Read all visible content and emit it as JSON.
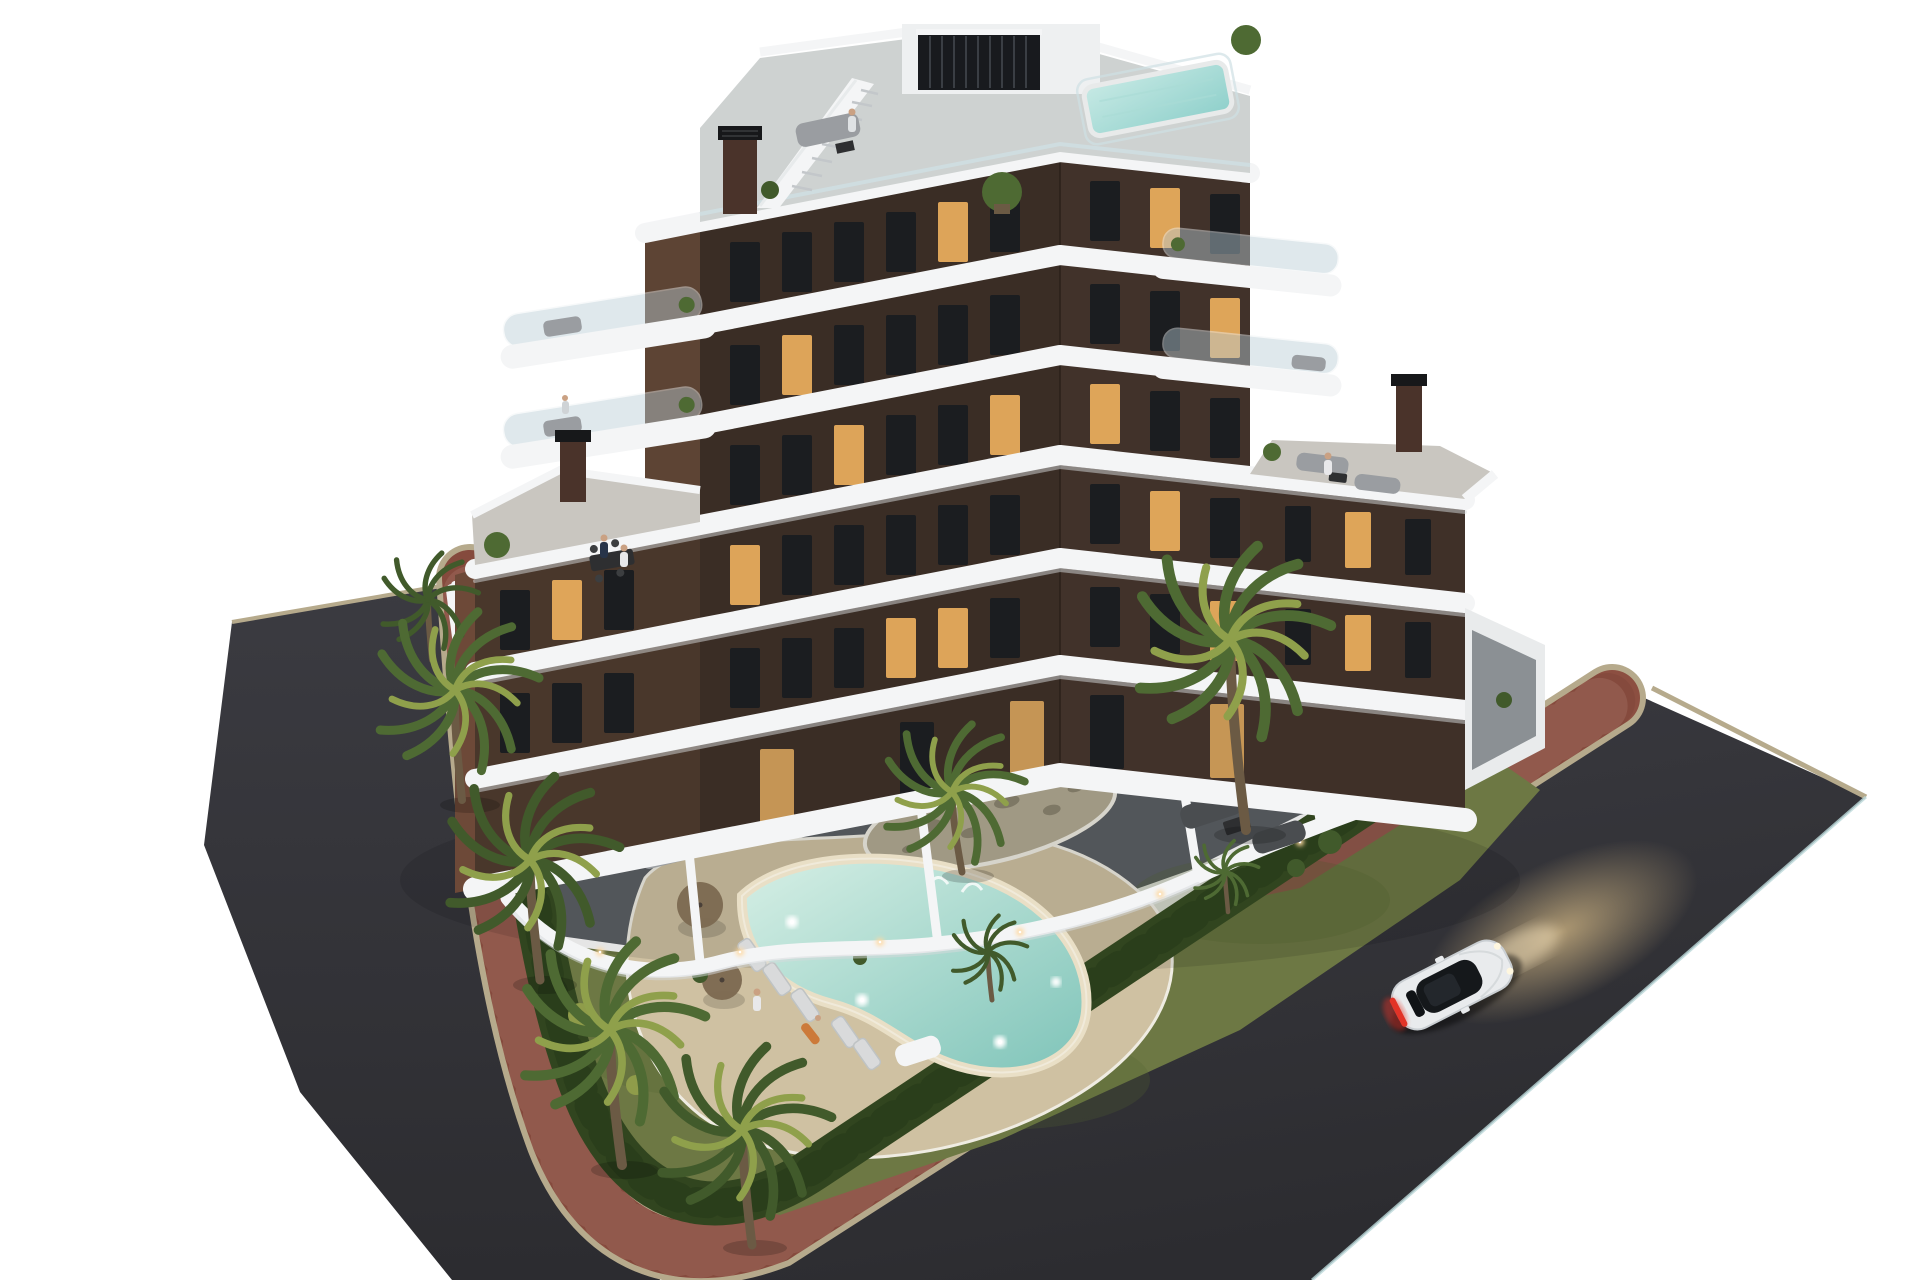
{
  "scene": {
    "type": "architectural-3d-render",
    "view": "aerial dusk exterior visualization on a plain white background",
    "description": "Seven-storey modern apartment building with dark brown facades wrapped by curved white balcony bands, rooftop terrace with plunge pool and external stair, landscaped garden with a free-form illuminated swimming pool, sandy pool deck with loungers and parasols, palm trees, perimeter hedge, red paver sidewalk and dark asphalt streets with one white coupe driving with its lights on.",
    "background": "#ffffff"
  },
  "building": {
    "storeys_visible": 7,
    "facade_finish": "dark brown with floor-to-ceiling windows, several lit warm",
    "balcony_style": "rounded white wrap-around balconies with glass railings",
    "roof_features": [
      "plunge pool",
      "external staircase",
      "louvered penthouse wall",
      "chimneys",
      "planters",
      "lounge furniture"
    ]
  },
  "grounds": {
    "features": [
      "free-form swimming pool with underwater lights",
      "sand-colored pool beach",
      "sun loungers",
      "parasols",
      "lawn",
      "palm trees",
      "perimeter hedge",
      "gravel island planter",
      "ground-floor terraces with dining and lounge sets",
      "garage ramp",
      "wall lights"
    ]
  },
  "street": {
    "surface": "dark asphalt",
    "sidewalk": "red clay pavers with light curb",
    "vehicle": {
      "type": "coupe",
      "color": "white",
      "state": "driving, headlights and taillights on"
    }
  },
  "colors": {
    "background": "#ffffff",
    "asphalt": "#2c2c30",
    "asphaltLight": "#3b3b41",
    "roadEdge": "#bcd8da",
    "curb": "#b6aa8c",
    "brick": "#8c4f41",
    "brickDark": "#6f3c33",
    "brickLight": "#caa28e",
    "hedge": "#31451f",
    "hedgeDark": "#233517",
    "lawn": "#6d7844",
    "lawnShade": "#55622f",
    "sand": "#cfc1a2",
    "sandEdge": "#efece2",
    "pebble": "#b3ab94",
    "poolShallow": "#d6efe5",
    "poolDeep": "#7fc4b9",
    "poolRim": "#e9dfc6",
    "roofPoolA": "#c6e9e4",
    "roofPoolB": "#8fd0cb",
    "facadeFront": "#3a2d25",
    "facadeFrontB": "#41322a",
    "facadeSide": "#6d4938",
    "facadeLight": "#49372b",
    "towerSide": "#5d4434",
    "rightWing": "#3f3028",
    "white": "#f4f5f6",
    "whiteShade": "#d5d9dc",
    "glassRail": "#cfe0e4",
    "deck": "#ced2d1",
    "deckWarm": "#c9c6c0",
    "terrace": "#5c6065",
    "patio": "#8e8d88",
    "glass": "#b9cdd4",
    "window": "#1b1d20",
    "windowLit": "#edb05e",
    "doorLit": "#d9a45c",
    "chimney": "#4a332a",
    "chimneyCap": "#17181a",
    "louver": "#181a1e",
    "palmGreen": "#4e6a33",
    "palmDark": "#415a2b",
    "palmLight": "#8fa04b",
    "trunk": "#6b5a44",
    "carBody": "#e9ebed",
    "carShade": "#c9ced2",
    "cabin": "#15181b",
    "tailLight": "#e23327",
    "glow": "#e8c98f",
    "furnGray": "#9a9da1",
    "furnLight": "#d9dadb",
    "furnDark": "#2e2f31",
    "rug": "#6e6257",
    "wallLight": "#ffd9a0",
    "skin": "#caa183"
  }
}
